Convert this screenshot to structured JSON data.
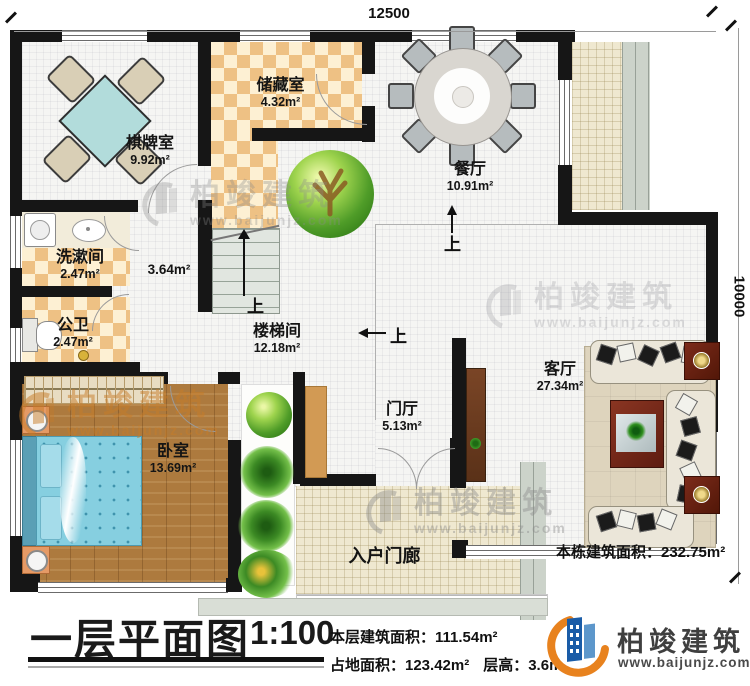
{
  "plan": {
    "dim_top": "12500",
    "dim_right": "10000",
    "up_label": "上",
    "total_area_note": "本栋建筑面积：232.75m²",
    "rooms": [
      {
        "name": "棋牌室",
        "area": "9.92m²"
      },
      {
        "name": "储藏室",
        "area": "4.32m²"
      },
      {
        "name": "餐厅",
        "area": "10.91m²"
      },
      {
        "name": "洗漱间",
        "area": "2.47m²"
      },
      {
        "name": "公卫",
        "area": "2.47m²"
      },
      {
        "name": "",
        "area": "3.64m²"
      },
      {
        "name": "楼梯间",
        "area": "12.18m²"
      },
      {
        "name": "门厅",
        "area": "5.13m²"
      },
      {
        "name": "客厅",
        "area": "27.34m²"
      },
      {
        "name": "卧室",
        "area": "13.69m²"
      },
      {
        "name": "入户门廊",
        "area": ""
      }
    ]
  },
  "footer": {
    "title": "一层平面图",
    "scale": "1:100",
    "floor_area": "本层建筑面积：111.54m²",
    "ground_area": "占地面积：123.42m²",
    "floor_height": "层高：3.6m"
  },
  "brand": {
    "name": "柏竣建筑",
    "site": "www.baijunjz.com"
  }
}
